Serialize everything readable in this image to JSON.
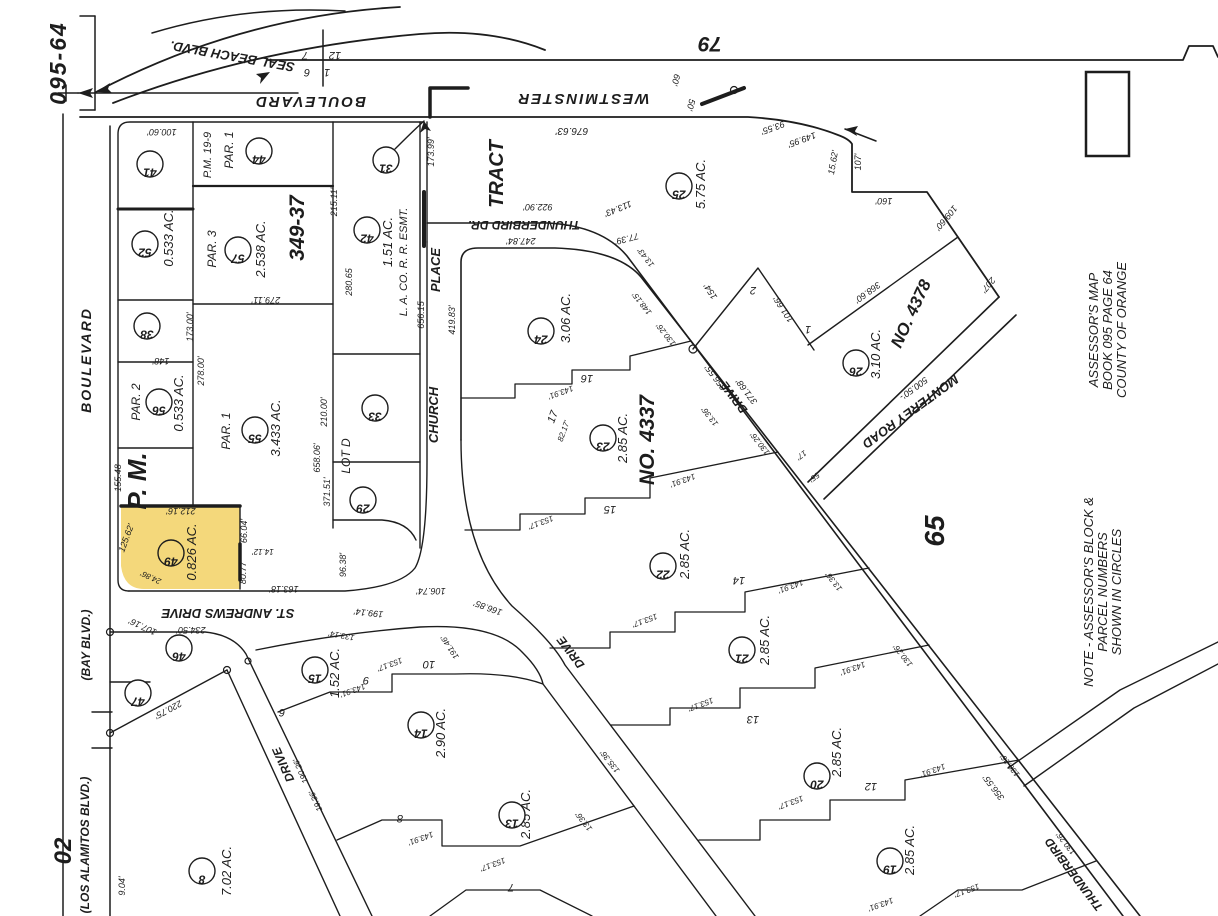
{
  "sheet": {
    "id": "095-64",
    "book_note": [
      "ASSESSOR'S  MAP",
      "BOOK 095  PAGE 64",
      "COUNTY OF ORANGE"
    ],
    "note": [
      "NOTE - ASSESSOR'S BLOCK &",
      "PARCEL  NUMBERS",
      "SHOWN  IN  CIRCLES"
    ]
  },
  "colors": {
    "ink": "#1d1d1d",
    "paper": "#ffffff",
    "highlight": "#f4d87b",
    "highlight_edge": "#a8780a"
  },
  "map": {
    "parcel_circles": [
      {
        "n": "41",
        "x": 150,
        "y": 164
      },
      {
        "n": "44",
        "x": 259,
        "y": 151
      },
      {
        "n": "31",
        "x": 386,
        "y": 160
      },
      {
        "n": "52",
        "x": 145,
        "y": 244
      },
      {
        "n": "57",
        "x": 238,
        "y": 250
      },
      {
        "n": "42",
        "x": 367,
        "y": 230
      },
      {
        "n": "38",
        "x": 147,
        "y": 326
      },
      {
        "n": "56",
        "x": 159,
        "y": 402
      },
      {
        "n": "55",
        "x": 255,
        "y": 430
      },
      {
        "n": "33",
        "x": 375,
        "y": 408
      },
      {
        "n": "25",
        "x": 679,
        "y": 186
      },
      {
        "n": "24",
        "x": 541,
        "y": 331
      },
      {
        "n": "29",
        "x": 363,
        "y": 500
      },
      {
        "n": "23",
        "x": 603,
        "y": 438
      },
      {
        "n": "26",
        "x": 856,
        "y": 363
      },
      {
        "n": "22",
        "x": 663,
        "y": 566
      },
      {
        "n": "49",
        "x": 171,
        "y": 553
      },
      {
        "n": "46",
        "x": 179,
        "y": 648
      },
      {
        "n": "47",
        "x": 138,
        "y": 693
      },
      {
        "n": "15",
        "x": 315,
        "y": 670
      },
      {
        "n": "21",
        "x": 742,
        "y": 650
      },
      {
        "n": "14",
        "x": 421,
        "y": 725
      },
      {
        "n": "20",
        "x": 817,
        "y": 776
      },
      {
        "n": "13",
        "x": 512,
        "y": 815
      },
      {
        "n": "8",
        "x": 202,
        "y": 871
      },
      {
        "n": "19",
        "x": 890,
        "y": 861
      }
    ],
    "lot_numbers": [
      {
        "t": "16",
        "x": 587,
        "y": 375
      },
      {
        "t": "15",
        "x": 610,
        "y": 506
      },
      {
        "t": "14",
        "x": 739,
        "y": 577
      },
      {
        "t": "13",
        "x": 753,
        "y": 716
      },
      {
        "t": "12",
        "x": 871,
        "y": 783
      },
      {
        "t": "10",
        "x": 429,
        "y": 661
      },
      {
        "t": "9",
        "x": 366,
        "y": 677
      },
      {
        "t": "8",
        "x": 400,
        "y": 815
      },
      {
        "t": "7",
        "x": 511,
        "y": 884
      },
      {
        "t": "6",
        "x": 282,
        "y": 709
      },
      {
        "t": "17",
        "x": 556,
        "y": 418,
        "r": -70
      },
      {
        "t": "2",
        "x": 753,
        "y": 287
      },
      {
        "t": "1",
        "x": 808,
        "y": 326
      },
      {
        "t": "7",
        "x": 305,
        "y": 52
      },
      {
        "t": "12",
        "x": 335,
        "y": 52
      },
      {
        "t": "6",
        "x": 307,
        "y": 69
      },
      {
        "t": "1",
        "x": 327,
        "y": 69
      }
    ],
    "road_labels": [
      {
        "t": "SEAL BEACH  BLVD.",
        "x": 233,
        "y": 52,
        "r": 190,
        "s": 13
      },
      {
        "t": "BOULEVARD",
        "x": 310,
        "y": 97,
        "r": 180,
        "s": 15,
        "ls": 2
      },
      {
        "t": "WESTMINSTER",
        "x": 583,
        "y": 94,
        "r": 180,
        "s": 15,
        "ls": 2
      },
      {
        "t": "79",
        "x": 710,
        "y": 37,
        "r": 180,
        "s": 21
      },
      {
        "t": "THUNDERBIRD  DR.",
        "x": 524,
        "y": 221,
        "r": 180,
        "s": 12
      },
      {
        "t": "CHURCH",
        "x": 438,
        "y": 415,
        "r": -90,
        "s": 13
      },
      {
        "t": "PLACE",
        "x": 440,
        "y": 270,
        "r": -90,
        "s": 13
      },
      {
        "t": "TRACT",
        "x": 503,
        "y": 174,
        "r": -90,
        "s": 20
      },
      {
        "t": "ST. ANDREWS  DRIVE",
        "x": 228,
        "y": 609,
        "r": 180,
        "s": 13
      },
      {
        "t": "DRIVE",
        "x": 287,
        "y": 763,
        "r": 246,
        "s": 12
      },
      {
        "t": "DRIVE",
        "x": 574,
        "y": 650,
        "r": 233,
        "s": 12
      },
      {
        "t": "DRIVE",
        "x": 737,
        "y": 395,
        "r": 233,
        "s": 12
      },
      {
        "t": "THUNDERBIRD",
        "x": 1077,
        "y": 872,
        "r": 233,
        "s": 12
      },
      {
        "t": "MONTEREY      ROAD",
        "x": 908,
        "y": 408,
        "r": 144,
        "s": 13
      },
      {
        "t": "BOULEVARD",
        "x": 91,
        "y": 360,
        "r": -90,
        "s": 14,
        "ls": 2
      },
      {
        "t": "(BAY  BLVD.)",
        "x": 90,
        "y": 645,
        "r": -90,
        "s": 12
      },
      {
        "t": "(LOS  ALAMITOS  BLVD.)",
        "x": 89,
        "y": 845,
        "r": -90,
        "s": 12
      }
    ],
    "area_labels": [
      {
        "t": "0.533 AC.",
        "x": 173,
        "y": 238
      },
      {
        "t": "2.538 AC.",
        "x": 265,
        "y": 249
      },
      {
        "t": "1.51 AC.",
        "x": 392,
        "y": 242
      },
      {
        "t": "0.533 AC.",
        "x": 183,
        "y": 403
      },
      {
        "t": "3.433 AC.",
        "x": 280,
        "y": 428
      },
      {
        "t": "0.826 AC.",
        "x": 196,
        "y": 552
      },
      {
        "t": "5.75 AC.",
        "x": 705,
        "y": 184
      },
      {
        "t": "3.06 AC.",
        "x": 570,
        "y": 318
      },
      {
        "t": "2.85 AC.",
        "x": 627,
        "y": 438
      },
      {
        "t": "3.10 AC.",
        "x": 880,
        "y": 354
      },
      {
        "t": "2.85 AC.",
        "x": 689,
        "y": 554
      },
      {
        "t": "2.85 AC.",
        "x": 769,
        "y": 640
      },
      {
        "t": "2.85 AC.",
        "x": 841,
        "y": 752
      },
      {
        "t": "2.85 AC.",
        "x": 914,
        "y": 850
      },
      {
        "t": "1.52 AC.",
        "x": 339,
        "y": 673
      },
      {
        "t": "2.90 AC.",
        "x": 445,
        "y": 733
      },
      {
        "t": "2.85 AC.",
        "x": 530,
        "y": 814
      },
      {
        "t": "7.02 AC.",
        "x": 231,
        "y": 871
      }
    ],
    "texts": [
      {
        "t": "100.60'",
        "x": 162,
        "y": 129,
        "r": 180
      },
      {
        "t": "60'",
        "x": 673,
        "y": 79,
        "r": 105
      },
      {
        "t": "50'",
        "x": 688,
        "y": 104,
        "r": 105
      },
      {
        "t": "676.63'",
        "x": 572,
        "y": 128,
        "r": 180,
        "s": 10
      },
      {
        "t": "93.55'",
        "x": 772,
        "y": 125,
        "r": 160
      },
      {
        "t": "149.95'",
        "x": 801,
        "y": 137,
        "r": 160
      },
      {
        "t": "15.62'",
        "x": 836,
        "y": 163,
        "r": -80
      },
      {
        "t": "107'",
        "x": 861,
        "y": 162,
        "r": -90
      },
      {
        "t": "160'",
        "x": 884,
        "y": 198,
        "r": 180
      },
      {
        "t": "109.60'",
        "x": 944,
        "y": 216,
        "r": 130
      },
      {
        "t": "207'",
        "x": 986,
        "y": 283,
        "r": 130
      },
      {
        "t": "173.99'",
        "x": 434,
        "y": 152,
        "r": -90
      },
      {
        "t": "215.11'",
        "x": 337,
        "y": 202,
        "r": -90
      },
      {
        "t": "280.65",
        "x": 352,
        "y": 282,
        "r": -90
      },
      {
        "t": "656.15",
        "x": 424,
        "y": 315,
        "r": -90
      },
      {
        "t": "922.90'",
        "x": 538,
        "y": 204,
        "r": 180
      },
      {
        "t": "247.84'",
        "x": 521,
        "y": 238,
        "r": 180
      },
      {
        "t": "113.43'",
        "x": 617,
        "y": 206,
        "r": 158
      },
      {
        "t": "77.39'",
        "x": 626,
        "y": 236,
        "r": 165
      },
      {
        "t": "L. A.  CO.  R. R.  ESMT.",
        "x": 407,
        "y": 262,
        "r": -90,
        "s": 11
      },
      {
        "t": "P.M. 19-9",
        "x": 211,
        "y": 155,
        "r": -90,
        "s": 11
      },
      {
        "t": "PAR. 1",
        "x": 233,
        "y": 150,
        "r": -90,
        "s": 12
      },
      {
        "t": "PAR. 3",
        "x": 216,
        "y": 249,
        "r": -90,
        "s": 12
      },
      {
        "t": "PAR. 2",
        "x": 140,
        "y": 402,
        "r": -90,
        "s": 12
      },
      {
        "t": "PAR. 1",
        "x": 230,
        "y": 431,
        "r": -90,
        "s": 12
      },
      {
        "t": "P. M.",
        "x": 146,
        "y": 481,
        "r": -90,
        "s": 26,
        "w": 700
      },
      {
        "t": "349-37",
        "x": 304,
        "y": 228,
        "r": -90,
        "s": 21,
        "w": 700
      },
      {
        "t": "NO. 4337",
        "x": 654,
        "y": 440,
        "r": -90,
        "s": 21,
        "w": 700
      },
      {
        "t": "NO. 4378",
        "x": 916,
        "y": 316,
        "r": -65,
        "s": 17,
        "w": 700
      },
      {
        "t": "65",
        "x": 944,
        "y": 531,
        "r": -90,
        "s": 28,
        "w": 700
      },
      {
        "t": "02",
        "x": 71,
        "y": 851,
        "r": -90,
        "s": 24,
        "w": 700
      },
      {
        "t": "LOT  D",
        "x": 350,
        "y": 456,
        "r": -90,
        "s": 12
      },
      {
        "t": "173.00'",
        "x": 193,
        "y": 327,
        "r": -90
      },
      {
        "t": "278.00'",
        "x": 204,
        "y": 371,
        "r": -90
      },
      {
        "t": "148'",
        "x": 161,
        "y": 358,
        "r": 180
      },
      {
        "t": "279.11'",
        "x": 266,
        "y": 297,
        "r": 180
      },
      {
        "t": "155.48",
        "x": 121,
        "y": 478,
        "r": -90
      },
      {
        "t": "125.62'",
        "x": 129,
        "y": 539,
        "r": -70
      },
      {
        "t": "212.16'",
        "x": 181,
        "y": 508,
        "r": 180
      },
      {
        "t": "66.04'",
        "x": 247,
        "y": 531,
        "r": -90
      },
      {
        "t": "80.77'",
        "x": 246,
        "y": 572,
        "r": -90
      },
      {
        "t": "14.12'",
        "x": 263,
        "y": 549,
        "r": 180,
        "s": 8
      },
      {
        "t": "24.86'",
        "x": 152,
        "y": 575,
        "r": 205,
        "s": 8
      },
      {
        "t": "163.18'",
        "x": 284,
        "y": 586,
        "r": 180
      },
      {
        "t": "371.51'",
        "x": 330,
        "y": 492,
        "r": -90
      },
      {
        "t": "658.06'",
        "x": 320,
        "y": 458,
        "r": -90
      },
      {
        "t": "210.00'",
        "x": 327,
        "y": 412,
        "r": -90
      },
      {
        "t": "96.38'",
        "x": 346,
        "y": 565,
        "r": -90
      },
      {
        "t": "106.74'",
        "x": 431,
        "y": 588,
        "r": 180
      },
      {
        "t": "199.14'",
        "x": 369,
        "y": 610,
        "r": 186
      },
      {
        "t": "166.85'",
        "x": 489,
        "y": 605,
        "r": 200
      },
      {
        "t": "234.50'",
        "x": 191,
        "y": 627,
        "r": 180
      },
      {
        "t": "107.16'",
        "x": 144,
        "y": 624,
        "r": 205
      },
      {
        "t": "220.75'",
        "x": 167,
        "y": 707,
        "r": 152
      },
      {
        "t": "9.04'",
        "x": 125,
        "y": 886,
        "r": -90
      },
      {
        "t": "368.60'",
        "x": 866,
        "y": 290,
        "r": 144
      },
      {
        "t": "500.50'-",
        "x": 912,
        "y": 386,
        "r": 144
      },
      {
        "t": "154'",
        "x": 713,
        "y": 290,
        "r": 237
      },
      {
        "t": "101.66'",
        "x": 786,
        "y": 308,
        "r": 237
      },
      {
        "t": "55'",
        "x": 813,
        "y": 475,
        "r": 144,
        "s": 8
      },
      {
        "t": "17'",
        "x": 800,
        "y": 453,
        "r": 144,
        "s": 8
      },
      {
        "t": "371.68'",
        "x": 749,
        "y": 390,
        "r": 233
      },
      {
        "t": "356.55'",
        "x": 718,
        "y": 376,
        "r": 233
      },
      {
        "t": "356.55'",
        "x": 996,
        "y": 786,
        "r": 233
      },
      {
        "t": "130.26'",
        "x": 668,
        "y": 333,
        "r": 232,
        "s": 8
      },
      {
        "t": "148.15'",
        "x": 644,
        "y": 302,
        "r": 232,
        "s": 8
      },
      {
        "t": "143.91'",
        "x": 560,
        "y": 390,
        "r": 160,
        "s": 8
      },
      {
        "t": "13.36'",
        "x": 712,
        "y": 415,
        "r": 232,
        "s": 8
      },
      {
        "t": "82.17'",
        "x": 566,
        "y": 432,
        "r": -70,
        "s": 8
      },
      {
        "t": "153.17'",
        "x": 540,
        "y": 520,
        "r": 160,
        "s": 8
      },
      {
        "t": "143.91'",
        "x": 682,
        "y": 478,
        "r": 160,
        "s": 8
      },
      {
        "t": "130.26'",
        "x": 762,
        "y": 442,
        "r": 232,
        "s": 8
      },
      {
        "t": "153.17'",
        "x": 644,
        "y": 618,
        "r": 160,
        "s": 8
      },
      {
        "t": "143.91'",
        "x": 790,
        "y": 584,
        "r": 160,
        "s": 8
      },
      {
        "t": "13.36'",
        "x": 836,
        "y": 580,
        "r": 232,
        "s": 8
      },
      {
        "t": "153.17'",
        "x": 700,
        "y": 702,
        "r": 160,
        "s": 8
      },
      {
        "t": "143.91'",
        "x": 852,
        "y": 666,
        "r": 160,
        "s": 8
      },
      {
        "t": "130.26'",
        "x": 905,
        "y": 654,
        "r": 232,
        "s": 8
      },
      {
        "t": "153.17'",
        "x": 790,
        "y": 800,
        "r": 160,
        "s": 8
      },
      {
        "t": "143.91'",
        "x": 932,
        "y": 768,
        "r": 160,
        "s": 8
      },
      {
        "t": "130.26'",
        "x": 1012,
        "y": 764,
        "r": 232,
        "s": 8
      },
      {
        "t": "153.17'",
        "x": 966,
        "y": 888,
        "r": 160,
        "s": 8
      },
      {
        "t": "143.91'",
        "x": 880,
        "y": 902,
        "r": 160,
        "s": 8
      },
      {
        "t": "130.26'",
        "x": 1068,
        "y": 842,
        "r": 232,
        "s": 8
      },
      {
        "t": "133.14'",
        "x": 342,
        "y": 633,
        "r": 190,
        "s": 8
      },
      {
        "t": "153.17'",
        "x": 389,
        "y": 662,
        "r": 160,
        "s": 8
      },
      {
        "t": "143.91'",
        "x": 352,
        "y": 688,
        "r": 160,
        "s": 8
      },
      {
        "t": "191.46'",
        "x": 452,
        "y": 646,
        "r": 237,
        "s": 8
      },
      {
        "t": "190.26'",
        "x": 303,
        "y": 770,
        "r": 246,
        "s": 8
      },
      {
        "t": "19.36'",
        "x": 318,
        "y": 800,
        "r": 246,
        "s": 8
      },
      {
        "t": "143.91'",
        "x": 420,
        "y": 836,
        "r": 160,
        "s": 8
      },
      {
        "t": "153.17'",
        "x": 492,
        "y": 862,
        "r": 160,
        "s": 8
      },
      {
        "t": "13.36'",
        "x": 586,
        "y": 820,
        "r": 232,
        "s": 8
      },
      {
        "t": "135.36'",
        "x": 612,
        "y": 760,
        "r": 232,
        "s": 8
      },
      {
        "t": "419.83'",
        "x": 455,
        "y": 320,
        "r": -90
      },
      {
        "t": "13.43'",
        "x": 648,
        "y": 256,
        "r": 232,
        "s": 8
      }
    ]
  }
}
